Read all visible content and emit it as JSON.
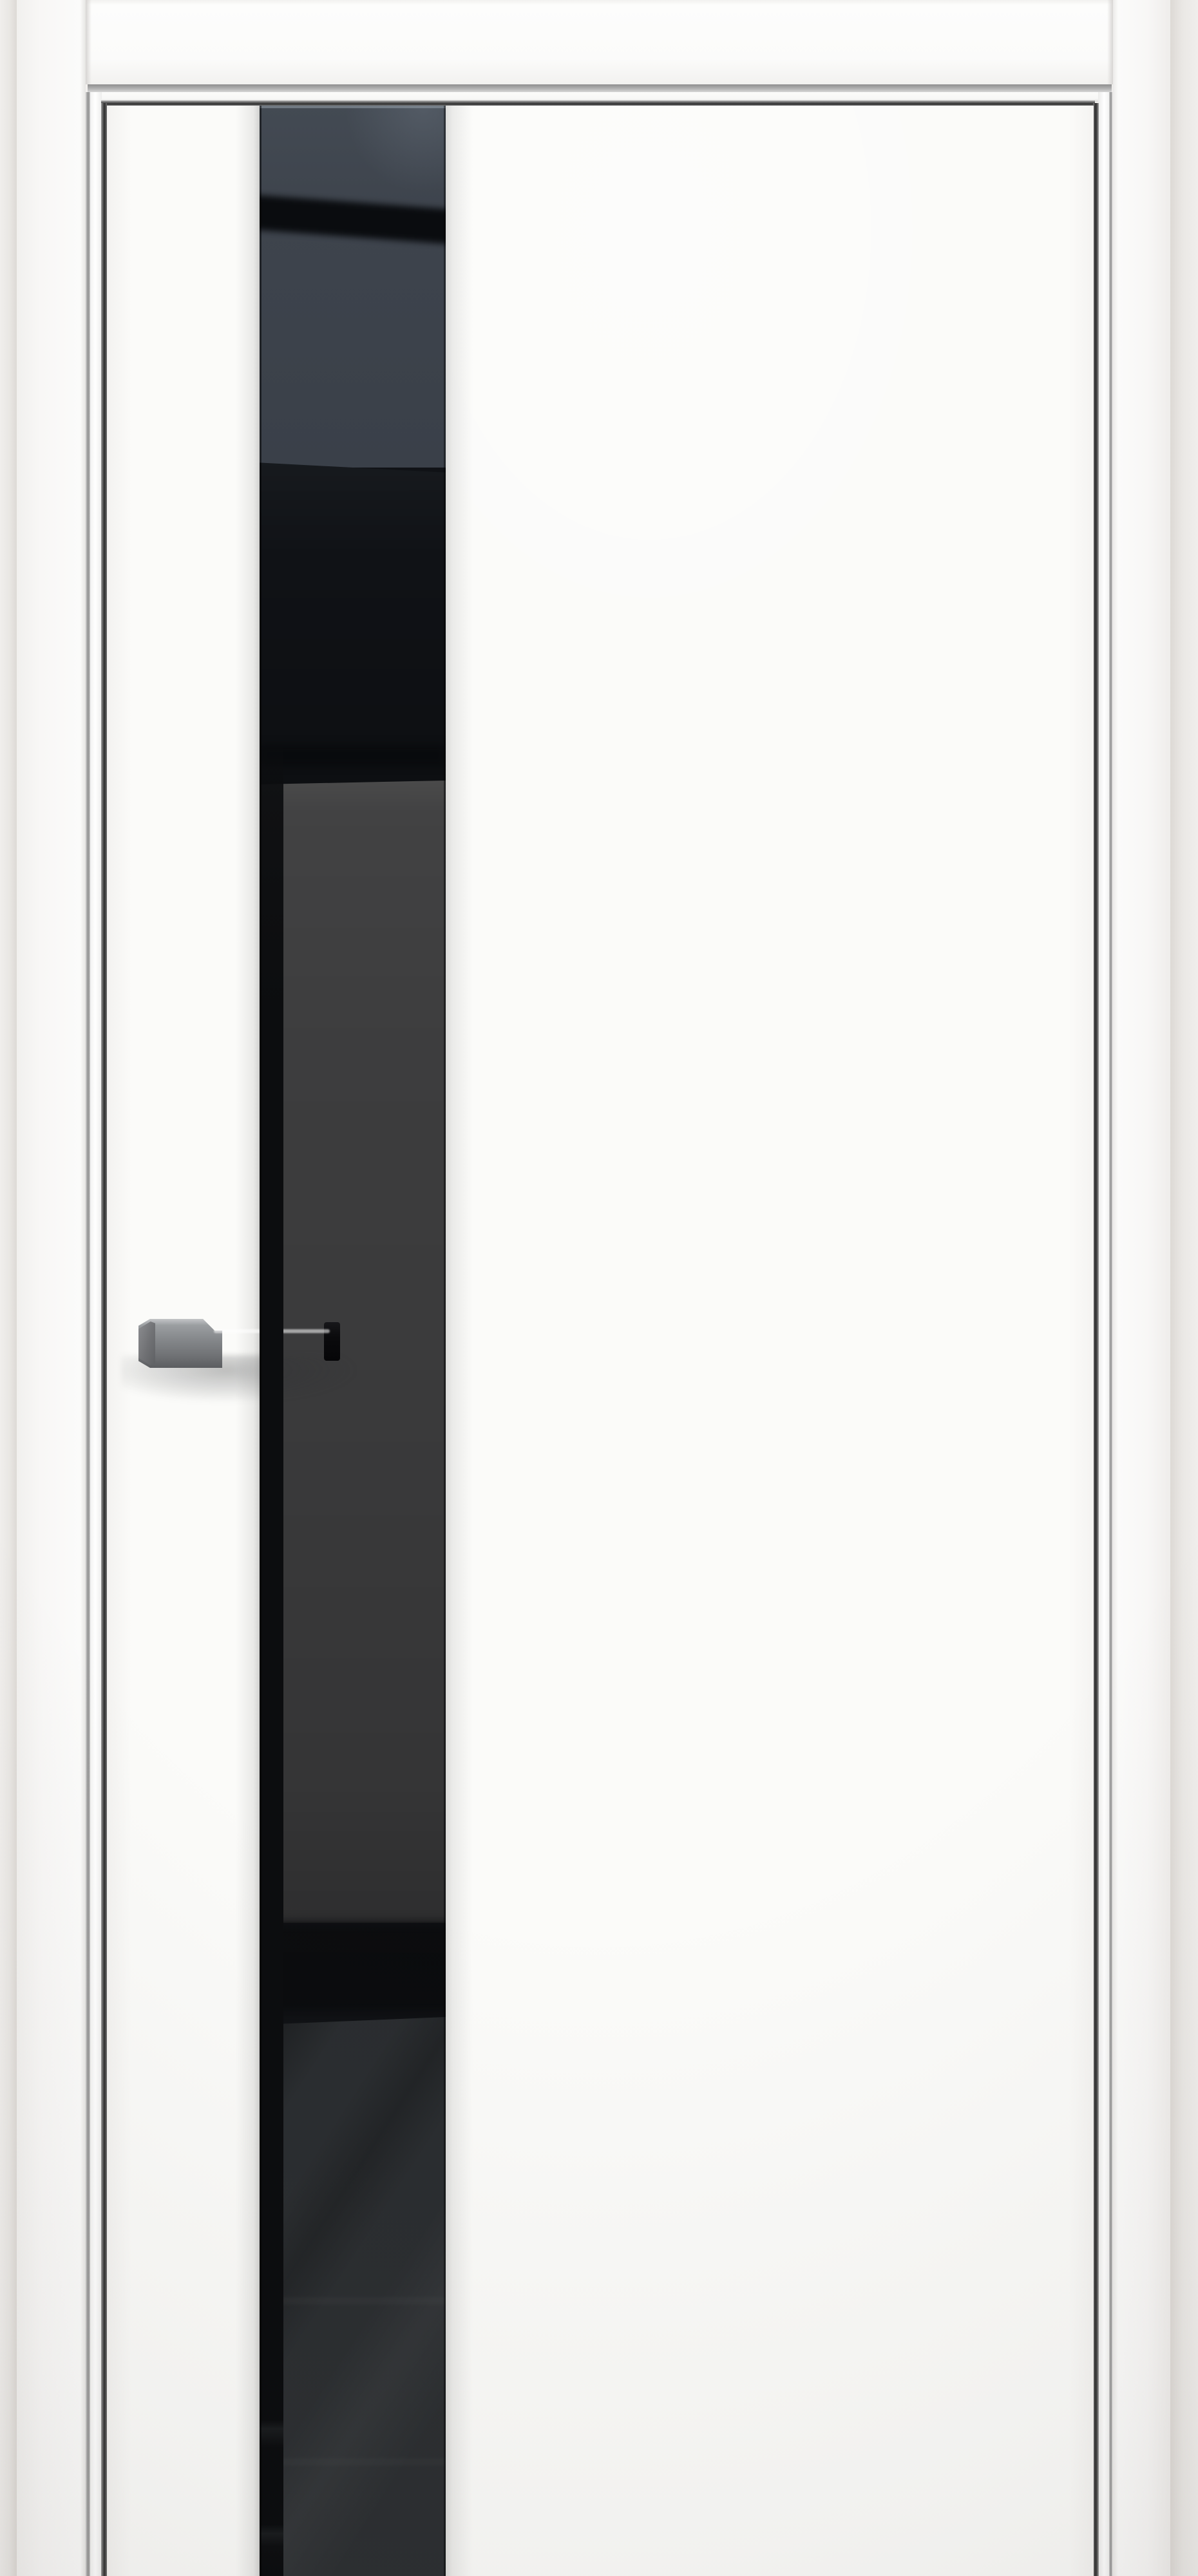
{
  "image": {
    "type": "product-render",
    "subject": "white interior door leaf with full-height glossy black glass stripe and grey metal lever handle",
    "view": "front, door closed, bottom cropped by image edge",
    "visible_text": ""
  },
  "colors": {
    "wall": "#f0eeec",
    "wall_shade": "#ddd9d5",
    "white_frame": "#f8f7f6",
    "white_door": "#fbfbf9",
    "metal_trim_light": "#d6d6d6",
    "metal_trim_dark": "#8e8e8e",
    "gap_shadow": "#2e2e2e",
    "glass_slate": "#3e444d",
    "glass_black": "#101216",
    "glass_panel": "#3b3b3c",
    "glass_charcoal": "#292c2f",
    "handle_highlight": "#d2d4d6",
    "handle_body": "#85888b",
    "handle_shadow_edge": "#55575a",
    "handle_base": "#0a0a0c"
  },
  "parts": {
    "wall": "surrounding wall",
    "lintel": "white head board above frame",
    "metal_reveal": "grey aluminium reveal line under head board",
    "casing_left": "left white frame casing",
    "casing_right": "right white frame casing",
    "jamb_left": "left jamb reveal",
    "jamb_right": "right jamb reveal",
    "door_slab": "white door leaf",
    "glass_stripe": "glossy black glass insert with room reflections",
    "handle": "grey square lever door handle"
  }
}
